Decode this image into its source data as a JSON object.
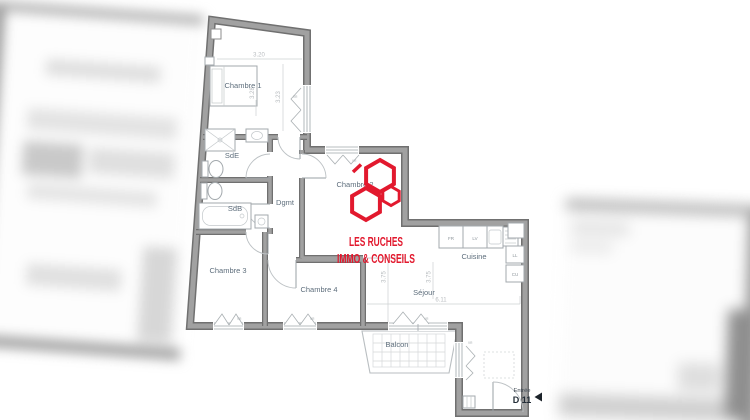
{
  "plan": {
    "rooms": {
      "chambre1": "Chambre 1",
      "sde": "SdE",
      "sdb": "SdB",
      "dgmt": "Dgmt",
      "chambre2": "Chambre 2",
      "chambre3": "Chambre 3",
      "chambre4": "Chambre 4",
      "cuisine": "Cuisine",
      "sejour": "Séjour",
      "balcon": "Balcon"
    },
    "dimensions": {
      "chambre1_width": "3.20",
      "chambre1_depth": "3.23",
      "chambre1_bed_wall": "3.28",
      "sejour_depth_a": "3.75",
      "sejour_depth_b": "3.75",
      "sejour_width": "6.11"
    },
    "kitchen_units": {
      "fridge": "FR",
      "dishwasher": "LV",
      "washing_machine": "LL",
      "cooking": "CU"
    },
    "window_shutter": "VR",
    "entrance": {
      "label": "Entrée",
      "unit": "D 11"
    }
  },
  "logo": {
    "line1": "LES RUCHES",
    "line2": "IMMO & CONSEILS"
  },
  "colors": {
    "wall_gray": "#8f8f8f",
    "room_label": "#5e6e7c",
    "dimension_text": "#b9bdc0",
    "logo_red": "#e2192e",
    "entrance_text": "#232d37"
  }
}
